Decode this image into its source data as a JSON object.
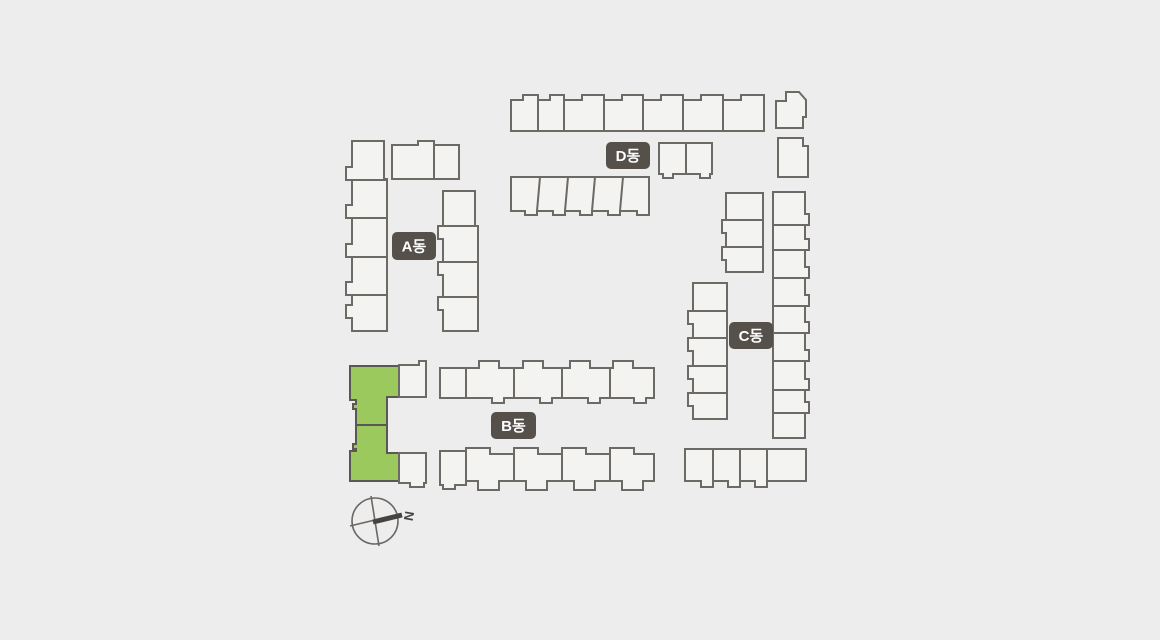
{
  "page": {
    "background": "#ededed",
    "title": "apartment-complex-site-plan"
  },
  "site_plan": {
    "canvas": {
      "width": 1160,
      "height": 640
    },
    "colors": {
      "background": "#ededed",
      "building_fill": "#f3f3f2",
      "building_stroke": "#6d6964",
      "highlight_fill": "#9cc95e",
      "highlight_stroke": "#5b5753",
      "label_bg": "#55504a",
      "label_text": "#ffffff",
      "compass_stroke": "#6b6764",
      "compass_needle": "#454240"
    },
    "labels": [
      {
        "id": "building-a-label",
        "text": "A동",
        "x": 392,
        "y": 232,
        "w": 44,
        "h": 28
      },
      {
        "id": "building-b-label",
        "text": "B동",
        "x": 491,
        "y": 412,
        "w": 45,
        "h": 27
      },
      {
        "id": "building-c-label",
        "text": "C동",
        "x": 729,
        "y": 322,
        "w": 44,
        "h": 27
      },
      {
        "id": "building-d-label",
        "text": "D동",
        "x": 606,
        "y": 142,
        "w": 44,
        "h": 27
      }
    ],
    "highlighted_building": "b-selected-unit",
    "compass": {
      "cx": 375,
      "cy": 521,
      "r": 23,
      "label": "N",
      "cross": [
        [
          371,
          496,
          379,
          546
        ],
        [
          350,
          526,
          400,
          514
        ]
      ],
      "needle": [
        373,
        522,
        402,
        515
      ],
      "label_pos": [
        409,
        516
      ],
      "label_rotation": 100
    },
    "buildings": [
      {
        "id": "a-wing-west",
        "highlighted": false,
        "path": "M352,141 L384,141 L384,179 L387,179 L387,331 L352,331 L352,318 L346,318 L346,305 L352,305 L352,295 L346,295 L346,282 L352,282 L352,257 L346,257 L346,244 L352,244 L352,218 L346,218 L346,205 L352,205 L352,180 L346,180 L346,167 L352,167 Z",
        "lines": "M352,180 L387,180 M352,218 L387,218 M352,257 L387,257 M352,295 L387,295"
      },
      {
        "id": "a-wing-north",
        "highlighted": false,
        "path": "M392,145 L418,145 L418,141 L434,141 L434,145 L459,145 L459,179 L392,179 Z",
        "lines": "M434,145 L434,179"
      },
      {
        "id": "a-wing-east",
        "highlighted": false,
        "path": "M443,191 L475,191 L475,226 L478,226 L478,331 L443,331 L443,310 L438,310 L438,297 L443,297 L443,275 L438,275 L438,262 L443,262 L443,239 L438,239 L438,226 L443,226 Z",
        "lines": "M443,226 L478,226 M443,262 L478,262 M443,297 L478,297"
      },
      {
        "id": "d-row-north",
        "highlighted": false,
        "path": "M511,131 L511,100 L523,100 L523,95 L538,95 L538,100 L550,100 L550,95 L564,95 L564,100 L582,100 L582,95 L604,95 L604,100 L622,100 L622,95 L643,95 L643,100 L661,100 L661,95 L683,95 L683,100 L701,100 L701,95 L723,95 L723,100 L741,100 L741,95 L764,95 L764,131 Z",
        "lines": "M538,98 L538,131 M564,98 L564,131 M604,98 L604,131 M643,98 L643,131 M683,98 L683,131 M723,98 L723,131"
      },
      {
        "id": "d-block-northeast-upper",
        "highlighted": false,
        "path": "M776,101 L786,101 L786,92 L799,92 L806,100 L806,117 L803,117 L803,128 L776,128 Z",
        "lines": ""
      },
      {
        "id": "d-block-northeast-lower",
        "highlighted": false,
        "path": "M778,138 L803,138 L803,146 L808,146 L808,177 L778,177 Z",
        "lines": ""
      },
      {
        "id": "d-block-pair",
        "highlighted": false,
        "path": "M659,143 L712,143 L712,174 L710,174 L710,178 L700,178 L700,174 L673,174 L673,178 L663,178 L663,174 L659,174 Z",
        "lines": "M686,143 L686,174"
      },
      {
        "id": "d-row-south",
        "highlighted": false,
        "path": "M511,177 L649,177 L649,215 L637,215 L637,211 L620,211 L620,215 L608,215 L608,211 L592,211 L592,215 L580,215 L580,211 L565,211 L565,215 L553,215 L553,211 L537,211 L537,215 L525,215 L525,211 L511,211 Z",
        "lines": "M540,177 L537,211 M568,177 L565,211 M595,177 L592,211 M623,177 L620,211"
      },
      {
        "id": "c-column-upper-left",
        "highlighted": false,
        "path": "M726,193 L763,193 L763,272 L726,272 L726,260 L722,260 L722,247 L726,247 L726,233 L722,233 L722,220 L726,220 Z",
        "lines": "M726,220 L763,220 M726,247 L763,247"
      },
      {
        "id": "c-column-lower-left",
        "highlighted": false,
        "path": "M693,283 L727,283 L727,419 L693,419 L693,406 L688,406 L688,393 L693,393 L693,379 L688,379 L688,366 L693,366 L693,351 L688,351 L688,338 L693,338 L693,324 L688,324 L688,311 L693,311 Z",
        "lines": "M693,311 L727,311 M693,338 L727,338 M693,366 L727,366 M693,393 L727,393"
      },
      {
        "id": "c-column-east",
        "highlighted": false,
        "path": "M773,192 L805,192 L805,214 L809,214 L809,225 L805,225 L805,239 L809,239 L809,250 L805,250 L805,267 L809,267 L809,278 L805,278 L805,295 L809,295 L809,306 L805,306 L805,322 L809,322 L809,333 L805,333 L805,350 L809,350 L809,361 L805,361 L805,379 L809,379 L809,390 L805,390 L805,402 L809,402 L809,413 L805,413 L805,438 L773,438 Z",
        "lines": "M773,225 L805,225 M773,250 L805,250 M773,278 L805,278 M773,306 L805,306 M773,333 L805,333 M773,361 L805,361 M773,390 L805,390 M773,413 L805,413"
      },
      {
        "id": "c-row-south",
        "highlighted": false,
        "path": "M685,449 L806,449 L806,481 L767,481 L767,487 L755,487 L755,481 L740,481 L740,487 L728,487 L728,481 L713,481 L713,487 L701,487 L701,481 L685,481 Z",
        "lines": "M713,449 L713,481 M740,449 L740,481 M767,449 L767,481"
      },
      {
        "id": "b-selected-unit",
        "highlighted": true,
        "path": "M350,366 L399,366 L399,397 L387,397 L387,453 L399,453 L399,481 L350,481 L350,451 L356,451 L356,449 L353,449 L353,444 L356,444 L356,409 L353,409 L353,404 L356,404 L356,400 L350,400 Z",
        "lines": "M356,425 L387,425"
      },
      {
        "id": "b-unit-upper-adjacent",
        "highlighted": false,
        "path": "M399,365 L419,365 L419,361 L426,361 L426,397 L399,397 Z",
        "lines": ""
      },
      {
        "id": "b-unit-lower-adjacent",
        "highlighted": false,
        "path": "M399,453 L426,453 L426,483 L424,483 L424,487 L410,487 L410,483 L399,483 Z",
        "lines": ""
      },
      {
        "id": "b-row-north",
        "highlighted": false,
        "path": "M440,368 L479,368 L479,361 L499,361 L499,368 L523,368 L523,361 L543,361 L543,368 L570,368 L570,361 L590,361 L590,368 L613,368 L613,361 L633,361 L633,368 L654,368 L654,398 L646,398 L646,403 L634,403 L634,398 L600,398 L600,403 L588,403 L588,398 L552,398 L552,403 L540,403 L540,398 L504,398 L504,403 L492,403 L492,398 L440,398 Z",
        "lines": "M466,368 L466,398 M514,368 L514,398 M562,368 L562,398 M610,368 L610,398"
      },
      {
        "id": "b-row-south",
        "highlighted": false,
        "path": "M440,451 L466,451 L466,448 L490,448 L490,454 L514,454 L514,448 L538,448 L538,454 L562,454 L562,448 L586,448 L586,454 L610,454 L610,448 L634,448 L634,454 L654,454 L654,481 L643,481 L643,490 L622,490 L622,481 L595,481 L595,490 L574,490 L574,481 L547,481 L547,490 L526,490 L526,481 L499,481 L499,490 L478,490 L478,481 L466,481 L466,485 L455,485 L455,489 L443,489 L443,485 L440,485 Z",
        "lines": "M466,451 L466,485 M514,454 L514,481 M562,454 L562,481 M610,454 L610,481"
      }
    ]
  }
}
